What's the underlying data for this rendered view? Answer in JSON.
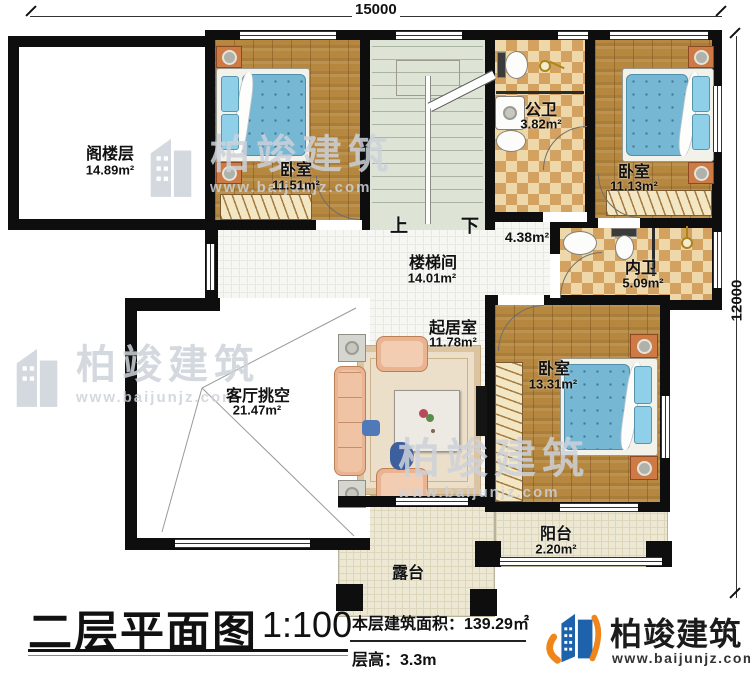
{
  "dimensions": {
    "top": "15000",
    "right": "12000"
  },
  "rooms": {
    "attic": {
      "name": "阁楼层",
      "area": "14.89m²"
    },
    "bedroom_tl": {
      "name": "卧室",
      "area": "11.51m²"
    },
    "public_bath": {
      "name": "公卫",
      "area": "3.82m²"
    },
    "bedroom_tr": {
      "name": "卧室",
      "area": "11.13m²"
    },
    "stairwell": {
      "name": "楼梯间",
      "area": "14.01m²"
    },
    "hall": {
      "area": "4.38m²"
    },
    "ensuite_bath": {
      "name": "内卫",
      "area": "5.09m²"
    },
    "sitting": {
      "name": "起居室",
      "area": "11.78m²"
    },
    "living_void": {
      "name": "客厅挑空",
      "area": "21.47m²"
    },
    "bedroom_br": {
      "name": "卧室",
      "area": "13.31m²"
    },
    "balcony": {
      "name": "阳台",
      "area": "2.20m²"
    },
    "terrace": {
      "name": "露台"
    }
  },
  "stairs": {
    "up": "上",
    "down": "下"
  },
  "footer": {
    "title": "二层平面图",
    "scale": "1:100",
    "area_text": "本层建筑面积：139.29㎡",
    "floor_height_text": "层高：3.3m"
  },
  "logo": {
    "name": "柏竣建筑",
    "url": "www.baijunjz.com"
  },
  "watermark": {
    "name": "柏竣建筑",
    "url": "www.baijunjz.com"
  },
  "colors": {
    "wall": "#0e0e0e",
    "logo_blue": "#1d62ab",
    "logo_orange": "#f08519"
  }
}
